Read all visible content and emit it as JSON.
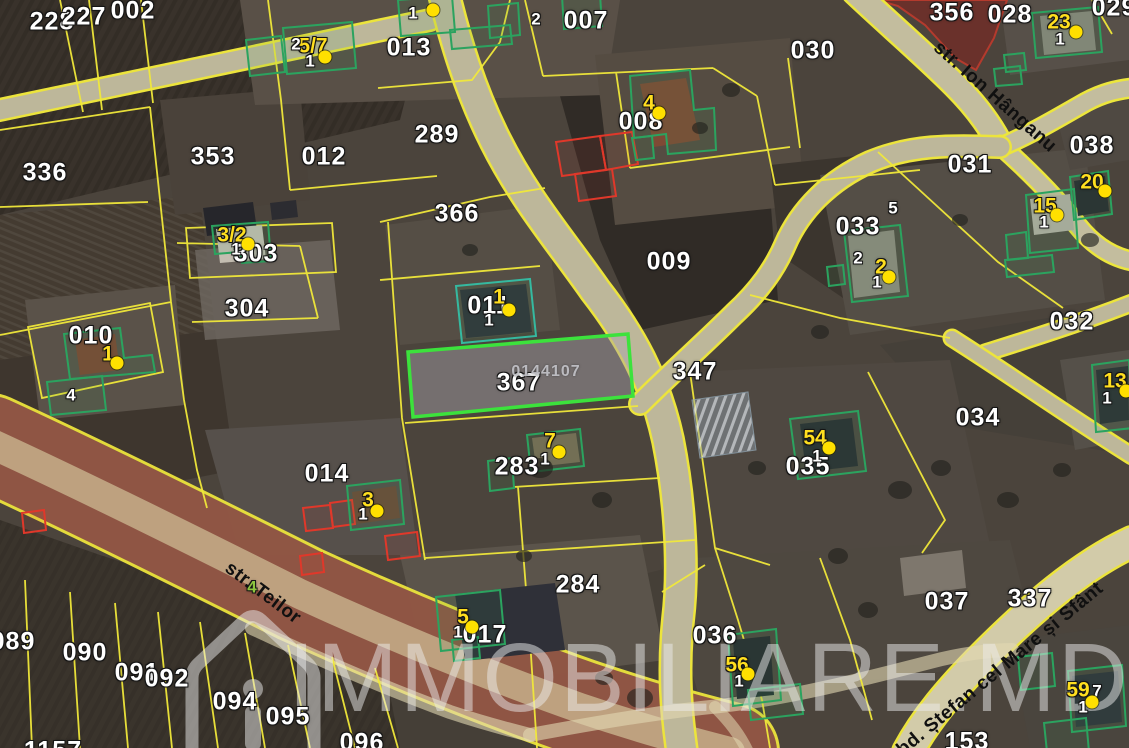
{
  "map": {
    "colors": {
      "boundary": "#f0e83a",
      "selection": "#3ce23c",
      "building_outline": "#2ba35f",
      "red_outline": "#e0382a",
      "label_white": "#ffffff",
      "label_yellow": "#ffdf1f",
      "marker": "#ffe000",
      "street_text": "#101010",
      "watermark": "#e6e6e6",
      "road_fill": "#bdb79a",
      "teilor_fill": "#8a4e45"
    },
    "watermark": {
      "text": "IMMOBILIARE.MD",
      "icon": "house-icon"
    },
    "selected_parcel": {
      "parcel_number": "367",
      "cadastral_id": "0144107"
    },
    "labels": [
      {
        "text": "228",
        "x": 52,
        "y": 22,
        "kind": "parcel"
      },
      {
        "text": "227",
        "x": 84,
        "y": 17,
        "kind": "parcel"
      },
      {
        "text": "002",
        "x": 133,
        "y": 11,
        "kind": "parcel"
      },
      {
        "text": "013",
        "x": 409,
        "y": 48,
        "kind": "parcel"
      },
      {
        "text": "007",
        "x": 586,
        "y": 21,
        "kind": "parcel"
      },
      {
        "text": "356",
        "x": 952,
        "y": 13,
        "kind": "parcel"
      },
      {
        "text": "028",
        "x": 1010,
        "y": 15,
        "kind": "parcel"
      },
      {
        "text": "029",
        "x": 1114,
        "y": 8,
        "kind": "parcel"
      },
      {
        "text": "030",
        "x": 813,
        "y": 51,
        "kind": "parcel"
      },
      {
        "text": "031",
        "x": 970,
        "y": 165,
        "kind": "parcel"
      },
      {
        "text": "038",
        "x": 1092,
        "y": 146,
        "kind": "parcel"
      },
      {
        "text": "032",
        "x": 1072,
        "y": 322,
        "kind": "parcel"
      },
      {
        "text": "336",
        "x": 45,
        "y": 173,
        "kind": "parcel"
      },
      {
        "text": "353",
        "x": 213,
        "y": 157,
        "kind": "parcel"
      },
      {
        "text": "012",
        "x": 324,
        "y": 157,
        "kind": "parcel"
      },
      {
        "text": "289",
        "x": 437,
        "y": 135,
        "kind": "parcel"
      },
      {
        "text": "008",
        "x": 641,
        "y": 122,
        "kind": "parcel"
      },
      {
        "text": "366",
        "x": 457,
        "y": 214,
        "kind": "parcel"
      },
      {
        "text": "009",
        "x": 669,
        "y": 262,
        "kind": "parcel"
      },
      {
        "text": "303",
        "x": 256,
        "y": 254,
        "kind": "parcel"
      },
      {
        "text": "304",
        "x": 247,
        "y": 309,
        "kind": "parcel"
      },
      {
        "text": "010",
        "x": 91,
        "y": 336,
        "kind": "parcel"
      },
      {
        "text": "011",
        "x": 489,
        "y": 306,
        "kind": "parcel"
      },
      {
        "text": "347",
        "x": 695,
        "y": 372,
        "kind": "parcel"
      },
      {
        "text": "367",
        "x": 519,
        "y": 383,
        "kind": "parcel"
      },
      {
        "text": "033",
        "x": 858,
        "y": 227,
        "kind": "parcel"
      },
      {
        "text": "034",
        "x": 978,
        "y": 418,
        "kind": "parcel"
      },
      {
        "text": "035",
        "x": 808,
        "y": 467,
        "kind": "parcel"
      },
      {
        "text": "014",
        "x": 327,
        "y": 474,
        "kind": "parcel"
      },
      {
        "text": "283",
        "x": 517,
        "y": 467,
        "kind": "parcel"
      },
      {
        "text": "284",
        "x": 578,
        "y": 585,
        "kind": "parcel"
      },
      {
        "text": "036",
        "x": 715,
        "y": 636,
        "kind": "parcel"
      },
      {
        "text": "037",
        "x": 947,
        "y": 602,
        "kind": "parcel"
      },
      {
        "text": "337",
        "x": 1030,
        "y": 599,
        "kind": "parcel"
      },
      {
        "text": "017",
        "x": 485,
        "y": 635,
        "kind": "parcel"
      },
      {
        "text": "089",
        "x": 13,
        "y": 642,
        "kind": "parcel"
      },
      {
        "text": "090",
        "x": 85,
        "y": 653,
        "kind": "parcel"
      },
      {
        "text": "091",
        "x": 137,
        "y": 673,
        "kind": "parcel"
      },
      {
        "text": "092",
        "x": 167,
        "y": 679,
        "kind": "parcel"
      },
      {
        "text": "094",
        "x": 235,
        "y": 702,
        "kind": "parcel"
      },
      {
        "text": "095",
        "x": 288,
        "y": 717,
        "kind": "parcel"
      },
      {
        "text": "096",
        "x": 362,
        "y": 743,
        "kind": "parcel"
      },
      {
        "text": "153",
        "x": 967,
        "y": 742,
        "kind": "parcel"
      },
      {
        "text": "1157",
        "x": 53,
        "y": 751,
        "kind": "parcel"
      },
      {
        "text": "5/7",
        "x": 313,
        "y": 46,
        "kind": "building"
      },
      {
        "text": "4",
        "x": 649,
        "y": 103,
        "kind": "building"
      },
      {
        "text": "3/2",
        "x": 232,
        "y": 235,
        "kind": "building"
      },
      {
        "text": "1",
        "x": 108,
        "y": 354,
        "kind": "building"
      },
      {
        "text": "1",
        "x": 499,
        "y": 297,
        "kind": "building"
      },
      {
        "text": "2",
        "x": 881,
        "y": 267,
        "kind": "building"
      },
      {
        "text": "15",
        "x": 1045,
        "y": 206,
        "kind": "building"
      },
      {
        "text": "20",
        "x": 1092,
        "y": 182,
        "kind": "building"
      },
      {
        "text": "23",
        "x": 1059,
        "y": 22,
        "kind": "building"
      },
      {
        "text": "13",
        "x": 1115,
        "y": 381,
        "kind": "building"
      },
      {
        "text": "54",
        "x": 815,
        "y": 438,
        "kind": "building"
      },
      {
        "text": "3",
        "x": 368,
        "y": 500,
        "kind": "building"
      },
      {
        "text": "7",
        "x": 550,
        "y": 441,
        "kind": "building"
      },
      {
        "text": "5",
        "x": 463,
        "y": 617,
        "kind": "building"
      },
      {
        "text": "56",
        "x": 737,
        "y": 665,
        "kind": "building"
      },
      {
        "text": "59",
        "x": 1078,
        "y": 690,
        "kind": "building"
      },
      {
        "text": "2",
        "x": 296,
        "y": 44,
        "kind": "sub"
      },
      {
        "text": "1",
        "x": 310,
        "y": 61,
        "kind": "sub"
      },
      {
        "text": "1",
        "x": 413,
        "y": 13,
        "kind": "sub"
      },
      {
        "text": "2",
        "x": 536,
        "y": 19,
        "kind": "sub"
      },
      {
        "text": "1",
        "x": 236,
        "y": 249,
        "kind": "sub"
      },
      {
        "text": "1",
        "x": 489,
        "y": 320,
        "kind": "sub"
      },
      {
        "text": "5",
        "x": 893,
        "y": 208,
        "kind": "sub"
      },
      {
        "text": "2",
        "x": 858,
        "y": 258,
        "kind": "sub"
      },
      {
        "text": "1",
        "x": 877,
        "y": 282,
        "kind": "sub"
      },
      {
        "text": "1",
        "x": 1044,
        "y": 222,
        "kind": "sub"
      },
      {
        "text": "1",
        "x": 1060,
        "y": 39,
        "kind": "sub"
      },
      {
        "text": "1",
        "x": 363,
        "y": 514,
        "kind": "sub"
      },
      {
        "text": "1",
        "x": 545,
        "y": 459,
        "kind": "sub"
      },
      {
        "text": "1",
        "x": 458,
        "y": 632,
        "kind": "sub"
      },
      {
        "text": "1",
        "x": 817,
        "y": 456,
        "kind": "sub"
      },
      {
        "text": "1",
        "x": 1107,
        "y": 398,
        "kind": "sub"
      },
      {
        "text": "1",
        "x": 739,
        "y": 681,
        "kind": "sub"
      },
      {
        "text": "1",
        "x": 1083,
        "y": 707,
        "kind": "sub"
      },
      {
        "text": "7",
        "x": 1097,
        "y": 691,
        "kind": "sub"
      },
      {
        "text": "4",
        "x": 71,
        "y": 395,
        "kind": "sub"
      },
      {
        "text": "4",
        "x": 252,
        "y": 587,
        "kind": "sub",
        "color": "#8dc63f"
      },
      {
        "text": "0144107",
        "x": 546,
        "y": 372,
        "kind": "cadastral"
      },
      {
        "text": "str. Ion Hânganu",
        "x": 995,
        "y": 97,
        "kind": "street",
        "angle": 41.5
      },
      {
        "text": "str. Teilor",
        "x": 263,
        "y": 593,
        "kind": "street",
        "angle": 37
      },
      {
        "text": "bd. Ștefan cel Mare și Sfânt",
        "x": 1000,
        "y": 669,
        "kind": "street",
        "angle": -39.5
      }
    ],
    "markers": [
      {
        "x": 325,
        "y": 57
      },
      {
        "x": 433,
        "y": 10
      },
      {
        "x": 659,
        "y": 113
      },
      {
        "x": 248,
        "y": 244
      },
      {
        "x": 117,
        "y": 363
      },
      {
        "x": 509,
        "y": 310
      },
      {
        "x": 889,
        "y": 277
      },
      {
        "x": 1057,
        "y": 215
      },
      {
        "x": 1105,
        "y": 191
      },
      {
        "x": 1076,
        "y": 32
      },
      {
        "x": 1126,
        "y": 391
      },
      {
        "x": 829,
        "y": 448
      },
      {
        "x": 377,
        "y": 511
      },
      {
        "x": 559,
        "y": 452
      },
      {
        "x": 472,
        "y": 627
      },
      {
        "x": 748,
        "y": 674
      },
      {
        "x": 1092,
        "y": 702
      }
    ]
  }
}
